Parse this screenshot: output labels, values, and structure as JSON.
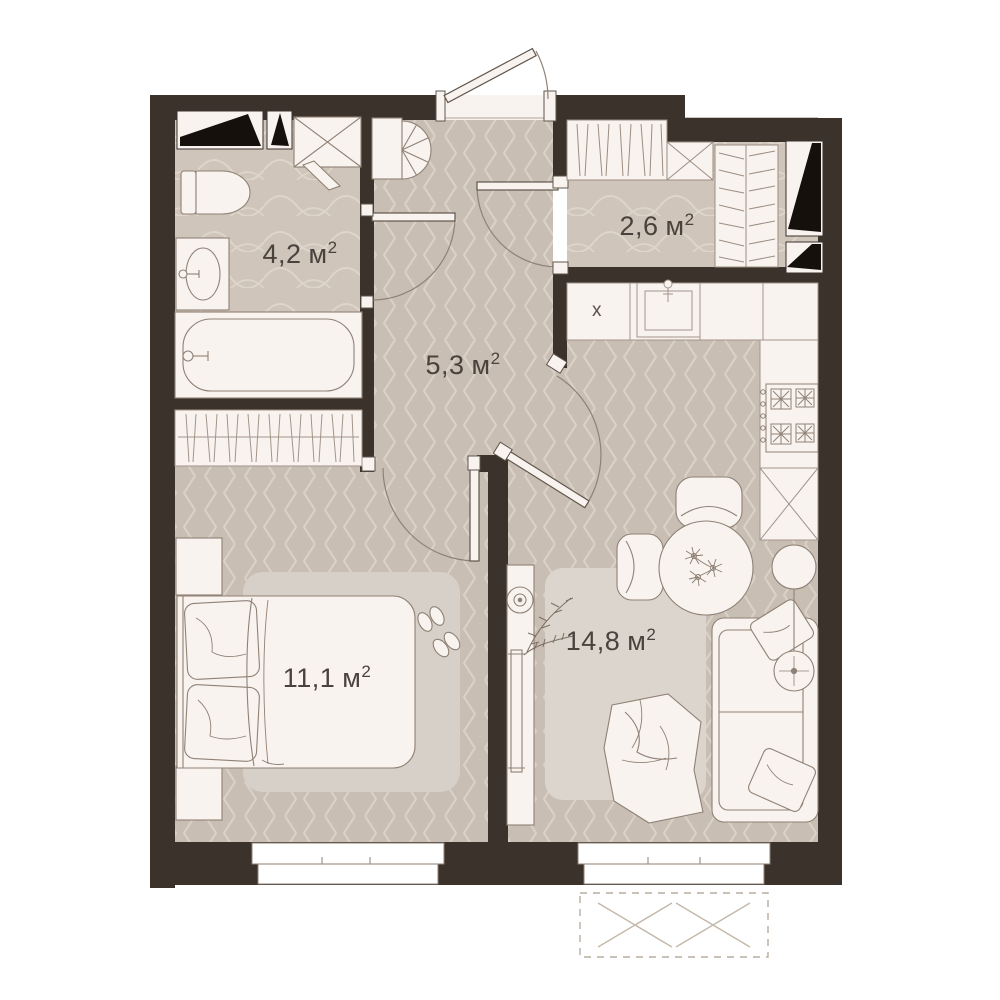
{
  "rooms": {
    "bathroom": {
      "area_value": "4,2",
      "area_unit": "м",
      "area_sup": "2"
    },
    "wardrobe": {
      "area_value": "2,6",
      "area_unit": "м",
      "area_sup": "2"
    },
    "hallway": {
      "area_value": "5,3",
      "area_unit": "м",
      "area_sup": "2"
    },
    "bedroom": {
      "area_value": "11,1",
      "area_unit": "м",
      "area_sup": "2"
    },
    "living_kitchen": {
      "area_value": "14,8",
      "area_unit": "м",
      "area_sup": "2"
    }
  },
  "kitchen": {
    "sink_marker": "х"
  },
  "colors": {
    "wall": "#3a322b",
    "floor_herringbone": "#c9beb3",
    "floor_waves": "#cfc5ba",
    "pattern_line": "#d9d0c6",
    "furniture_fill": "#f9f3f0",
    "outline": "#8f8175",
    "rug_bedroom": "#d7d0c8",
    "rug_living": "#dcd5cd",
    "vent_black": "#16100c",
    "label_text": "#4a423c"
  }
}
